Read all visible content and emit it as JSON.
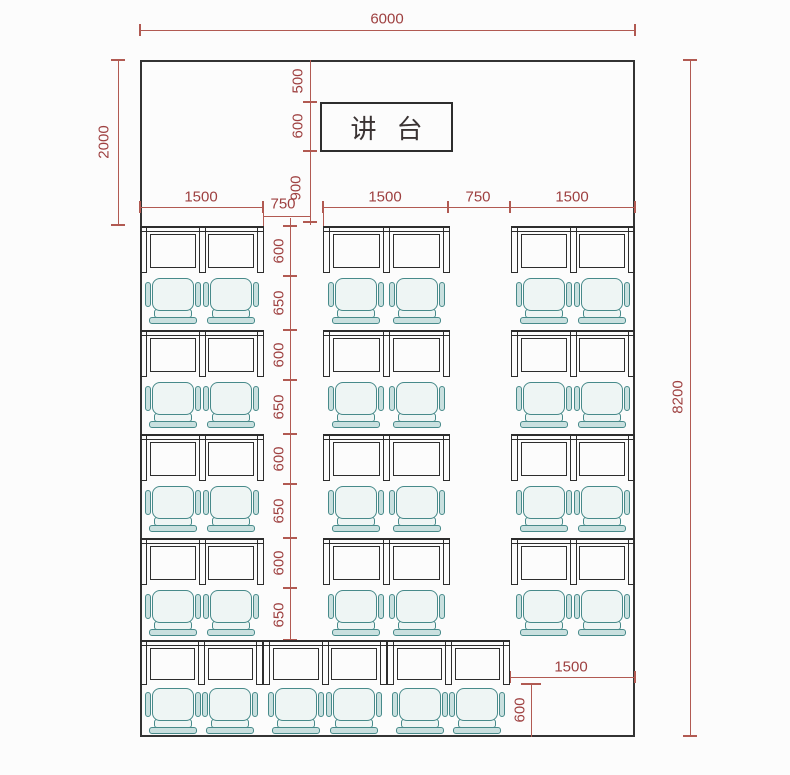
{
  "plan": {
    "podium_label": "讲台",
    "dims": {
      "room_width": "6000",
      "front_zone_depth": "2000",
      "room_depth": "8200",
      "wall_to_podium": "500",
      "podium_depth": "600",
      "podium_to_first_row": "900",
      "left_column_width": "1500",
      "left_aisle_width": "750",
      "middle_column_width": "1500",
      "right_aisle_width": "750",
      "right_column_width": "1500",
      "back_clear_width": "1500",
      "back_clear_depth": "600"
    },
    "rows": [
      {
        "desk_depth": "600",
        "seat_depth": "650"
      },
      {
        "desk_depth": "600",
        "seat_depth": "650"
      },
      {
        "desk_depth": "600",
        "seat_depth": "650"
      },
      {
        "desk_depth": "600",
        "seat_depth": "650"
      }
    ]
  },
  "colors": {
    "dimension_line": "#b15a52",
    "dimension_text": "#9e4040",
    "furniture_line": "#2d2d2d",
    "chair_line": "#478a8a",
    "chair_fill": "#eef5f4",
    "chair_fill_shade": "#c9e0df",
    "wall": "#333333",
    "podium_text": "#3a3333",
    "background": "#fcfcfc"
  }
}
